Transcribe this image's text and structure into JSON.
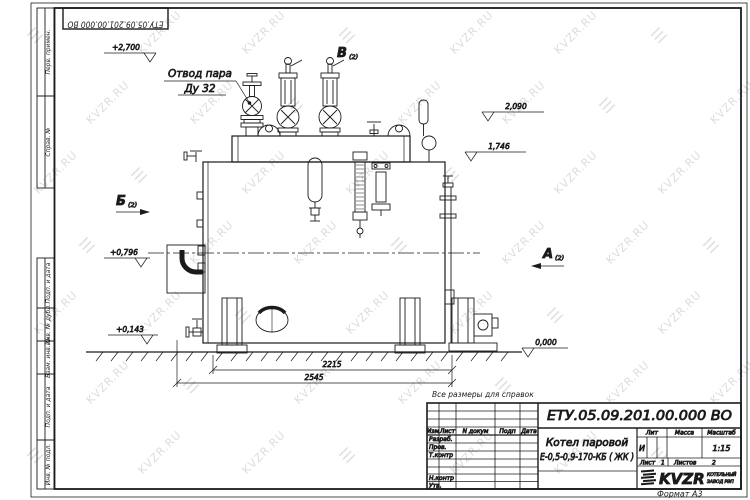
{
  "page": {
    "reference_note": "Все размеры для справок",
    "format_note": "Формат А3",
    "line_color": "#1b1b1b",
    "watermark_color": "#bdc1c8"
  },
  "watermark": {
    "text": "KVZR.RU"
  },
  "corner_stamp": {
    "doc_number": "ЕТУ.05.09.201.00.000  ВО"
  },
  "margin": {
    "top_cells": [
      "Перв. примен.",
      "Справ. №"
    ],
    "bottom_cells": [
      "Подп. и дата",
      "Инв. № дубл.",
      "Взам. инв. №",
      "Подп. и дата",
      "Инв. № подл."
    ]
  },
  "drawing": {
    "callout_line1": "Отвод пара",
    "callout_line2": "Ду 32",
    "views": {
      "a": "А",
      "b": "Б",
      "v": "В",
      "sheet_ref": "(2)"
    },
    "levels": {
      "top": "+2,700",
      "drum": "2,090",
      "mid": "1,746",
      "axis": "+0,796",
      "low": "+0,143",
      "ground": "0,000"
    },
    "dims": {
      "inner": "2215",
      "outer": "2545"
    }
  },
  "title_block": {
    "doc_number": "ЕТУ.05.09.201.00.000  ВО",
    "name_line1": "Котел паровой",
    "name_line2": "Е-0,5-0,9-170-КБ ( ЖК )",
    "hdr": {
      "izm": "Изм",
      "list": "Лист",
      "ndoc": "N докум",
      "podp": "Подп",
      "data": "Дата"
    },
    "rows": {
      "razrab": "Разраб.",
      "prov": "Пров.",
      "tkontr": "Т.контр",
      "nkontr": "Н.контр",
      "utv": "Утв."
    },
    "lit": {
      "header": "Лит",
      "value": "И"
    },
    "massa": {
      "header": "Масса"
    },
    "masshtab": {
      "header": "Масштаб",
      "value": "1:15"
    },
    "sheet": {
      "label": "Лист",
      "value": "1"
    },
    "sheets": {
      "label": "Листов",
      "value": "2"
    },
    "logo": {
      "text": "KVZR",
      "sub1": "КОТЕЛЬНЫЙ",
      "sub2": "ЗАВОД РЭП"
    }
  }
}
